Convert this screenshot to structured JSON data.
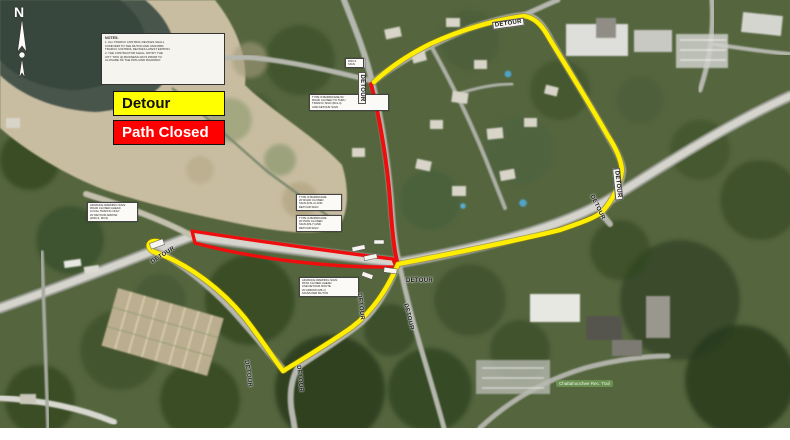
{
  "legend": {
    "detour_label": "Detour",
    "path_closed_label": "Path Closed",
    "detour_color": "#FFFF00",
    "path_closed_color": "#FF0000"
  },
  "north_label": "N",
  "detour_text": "DETOUR",
  "route_colors": {
    "detour_line": "#FFEE00",
    "closed_line": "#EE0E0E"
  },
  "notes_box": {
    "title": "NOTES:",
    "lines": [
      "1. ALL TRAFFIC CONTROL DEVICES SHALL",
      "   CONFORM TO THE MUTCD AND UNIFORM",
      "   TRAFFIC CONTROL DEVICES LATEST EDITION.",
      "2. THE CONTRACTOR SHALL NOTIFY THE",
      "   CITY TWO (2) BUSINESS DAYS PRIOR TO",
      "   CLOSURE OF THE PATH AND ROADWAY."
    ]
  },
  "callouts": {
    "left": {
      "lines": [
        "ADVANCE WARNING SIGN:",
        "ROAD CLOSED AHEAD",
        "LOCAL TRAFFIC ONLY",
        "W/ DETOUR ARROW",
        "(W20-3, M4-9)"
      ]
    },
    "north": {
      "lines": [
        "TYPE III BARRICADE W/",
        "ROAD CLOSED TO THRU",
        "TRAFFIC SIGN (R11-4)",
        "AND DETOUR SIGN"
      ]
    },
    "mid_upper": {
      "lines": [
        "TYPE III BARRICADE",
        "W/ ROAD CLOSED",
        "SIGN (R11-2) AND",
        "DETOUR SIGN"
      ]
    },
    "mid_lower": {
      "lines": [
        "TYPE III BARRICADE",
        "W/ PATH CLOSED",
        "SIGN (R9-7) AND",
        "DETOUR SIGN"
      ]
    },
    "south": {
      "lines": [
        "ADVANCE WARNING SIGN:",
        "PATH CLOSED AHEAD",
        "USE DETOUR ROUTE",
        "W/ ARROW (M6-1)",
        "SIGNS PER MUTCD"
      ]
    },
    "small": {
      "lines": [
        "W20-3",
        "SIGN"
      ]
    }
  },
  "park_label": "Chattahoochee Rec. Trail"
}
